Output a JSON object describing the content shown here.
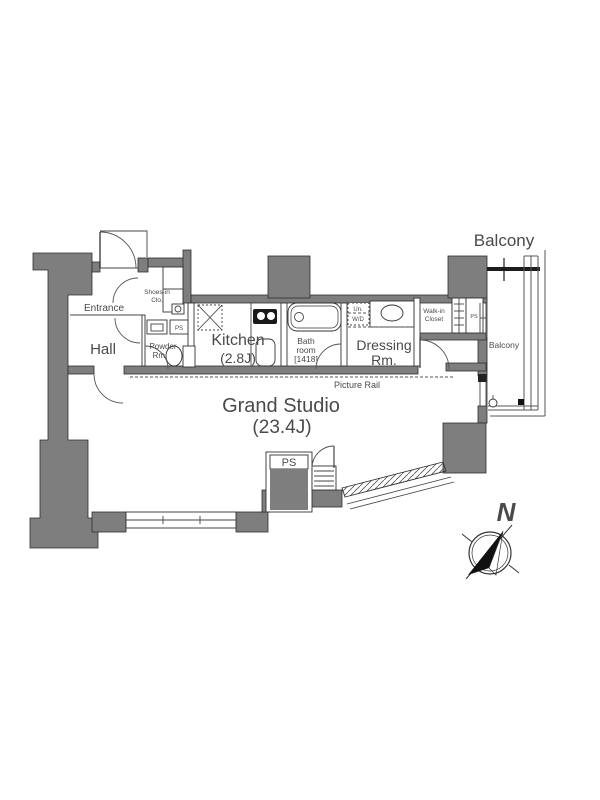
{
  "colors": {
    "background": "#ffffff",
    "wall_fill": "#7e7e7e",
    "line": "#2e2e2e",
    "label_text": "#4a4a4a"
  },
  "floor_plan": {
    "balcony": {
      "title": "Balcony",
      "side_label": "Balcony"
    },
    "entrance": {
      "label": "Entrance"
    },
    "shoes_closet": {
      "line1": "Shoes-in",
      "line2": "Clo."
    },
    "hall": {
      "label": "Hall"
    },
    "powder_room": {
      "line1": "Powder",
      "line2": "Rm.",
      "ps_label": "PS"
    },
    "kitchen": {
      "line1": "Kitchen",
      "line2": "(2.8J)"
    },
    "bath_room": {
      "line1": "Bath",
      "line2": "room",
      "line3": "[1418]"
    },
    "washer_dryer": {
      "line1": "Un.",
      "line2": "W/D"
    },
    "dressing_room": {
      "line1": "Dressing",
      "line2": "Rm."
    },
    "walk_in_closet": {
      "line1": "Walk-in",
      "line2": "Closet",
      "ps_label": "PS"
    },
    "picture_rail": {
      "label": "Picture Rail"
    },
    "studio": {
      "line1": "Grand Studio",
      "line2": "(23.4J)"
    },
    "pipe_space_bottom": {
      "label": "PS"
    },
    "compass": {
      "north": "N"
    }
  }
}
